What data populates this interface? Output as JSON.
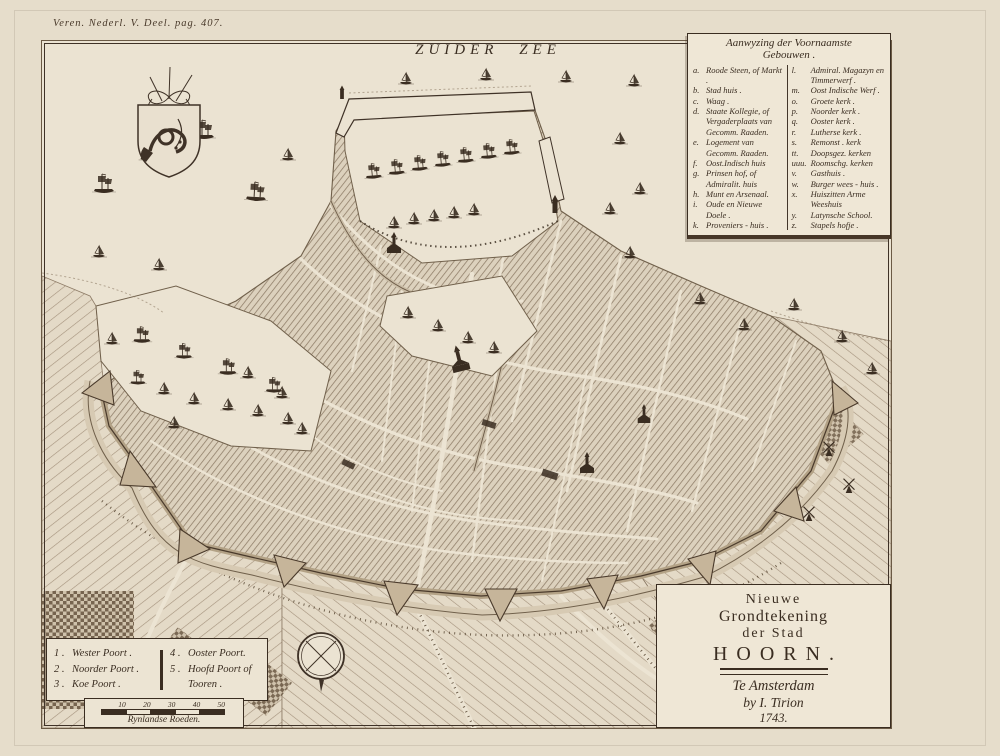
{
  "page": {
    "page_ref": "Veren. Nederl. V. Deel. pag. 407.",
    "sea_label": "ZUIDER ZEE"
  },
  "legend": {
    "title_line1": "Aanwyzing der Voornaamste",
    "title_line2": "Gebouwen .",
    "left": [
      {
        "key": "a.",
        "label": "Roode Steen, of Markt ."
      },
      {
        "key": "b.",
        "label": "Stad huis ."
      },
      {
        "key": "c.",
        "label": "Waag ."
      },
      {
        "key": "d.",
        "label": "Staate Kollegie, of Vergaderplaats van Gecomm. Raaden."
      },
      {
        "key": "e.",
        "label": "Logement van Gecomm. Raaden."
      },
      {
        "key": "f.",
        "label": "Oost.Indisch huis"
      },
      {
        "key": "g.",
        "label": "Prinsen hof, of Admiralit. huis"
      },
      {
        "key": "h.",
        "label": "Munt en Arsenaal."
      },
      {
        "key": "i.",
        "label": "Oude en Nieuwe Doele ."
      },
      {
        "key": "k.",
        "label": "Proveniers - huis ."
      }
    ],
    "right": [
      {
        "key": "l.",
        "label": "Admiral. Magazyn en Timmerwerf ."
      },
      {
        "key": "m.",
        "label": "Oost Indische Werf ."
      },
      {
        "key": "o.",
        "label": "Groete kerk ."
      },
      {
        "key": "p.",
        "label": "Noorder kerk ."
      },
      {
        "key": "q.",
        "label": "Ooster kerk ."
      },
      {
        "key": "r.",
        "label": "Lutherse kerk ."
      },
      {
        "key": "s.",
        "label": "Remonst . kerk"
      },
      {
        "key": "tt.",
        "label": "Doopsgez. kerken"
      },
      {
        "key": "uuu.",
        "label": "Roomschg. kerken"
      },
      {
        "key": "v.",
        "label": "Gasthuis ."
      },
      {
        "key": "w.",
        "label": "Burger wees - huis ."
      },
      {
        "key": "x.",
        "label": "Huiszitten Arme Weeshuis"
      },
      {
        "key": "y.",
        "label": "Latynsche School."
      },
      {
        "key": "z.",
        "label": "Stapels hofje ."
      }
    ]
  },
  "gates": {
    "left": [
      {
        "num": "1 .",
        "label": "Wester Poort ."
      },
      {
        "num": "2 .",
        "label": "Noorder Poort ."
      },
      {
        "num": "3 .",
        "label": "Koe Poort ."
      }
    ],
    "right": [
      {
        "num": "4 .",
        "label": "Ooster Poort."
      },
      {
        "num": "5 .",
        "label": "Hoofd Poort of Tooren ."
      }
    ]
  },
  "scale_bar": {
    "ticks": [
      "10",
      "20",
      "30",
      "40",
      "50"
    ],
    "label": "Rynlandse Roeden."
  },
  "cartouche": {
    "line1": "Nieuwe",
    "line2": "Grondtekening",
    "line3": "der Stad",
    "city": "HOORN.",
    "imprint1": "Te Amsterdam",
    "imprint2": "by I. Tirion",
    "year": "1743."
  },
  "colors": {
    "paper": "#ebe3d2",
    "ink": "#3a2d21",
    "hatch": "#8d7b66"
  }
}
